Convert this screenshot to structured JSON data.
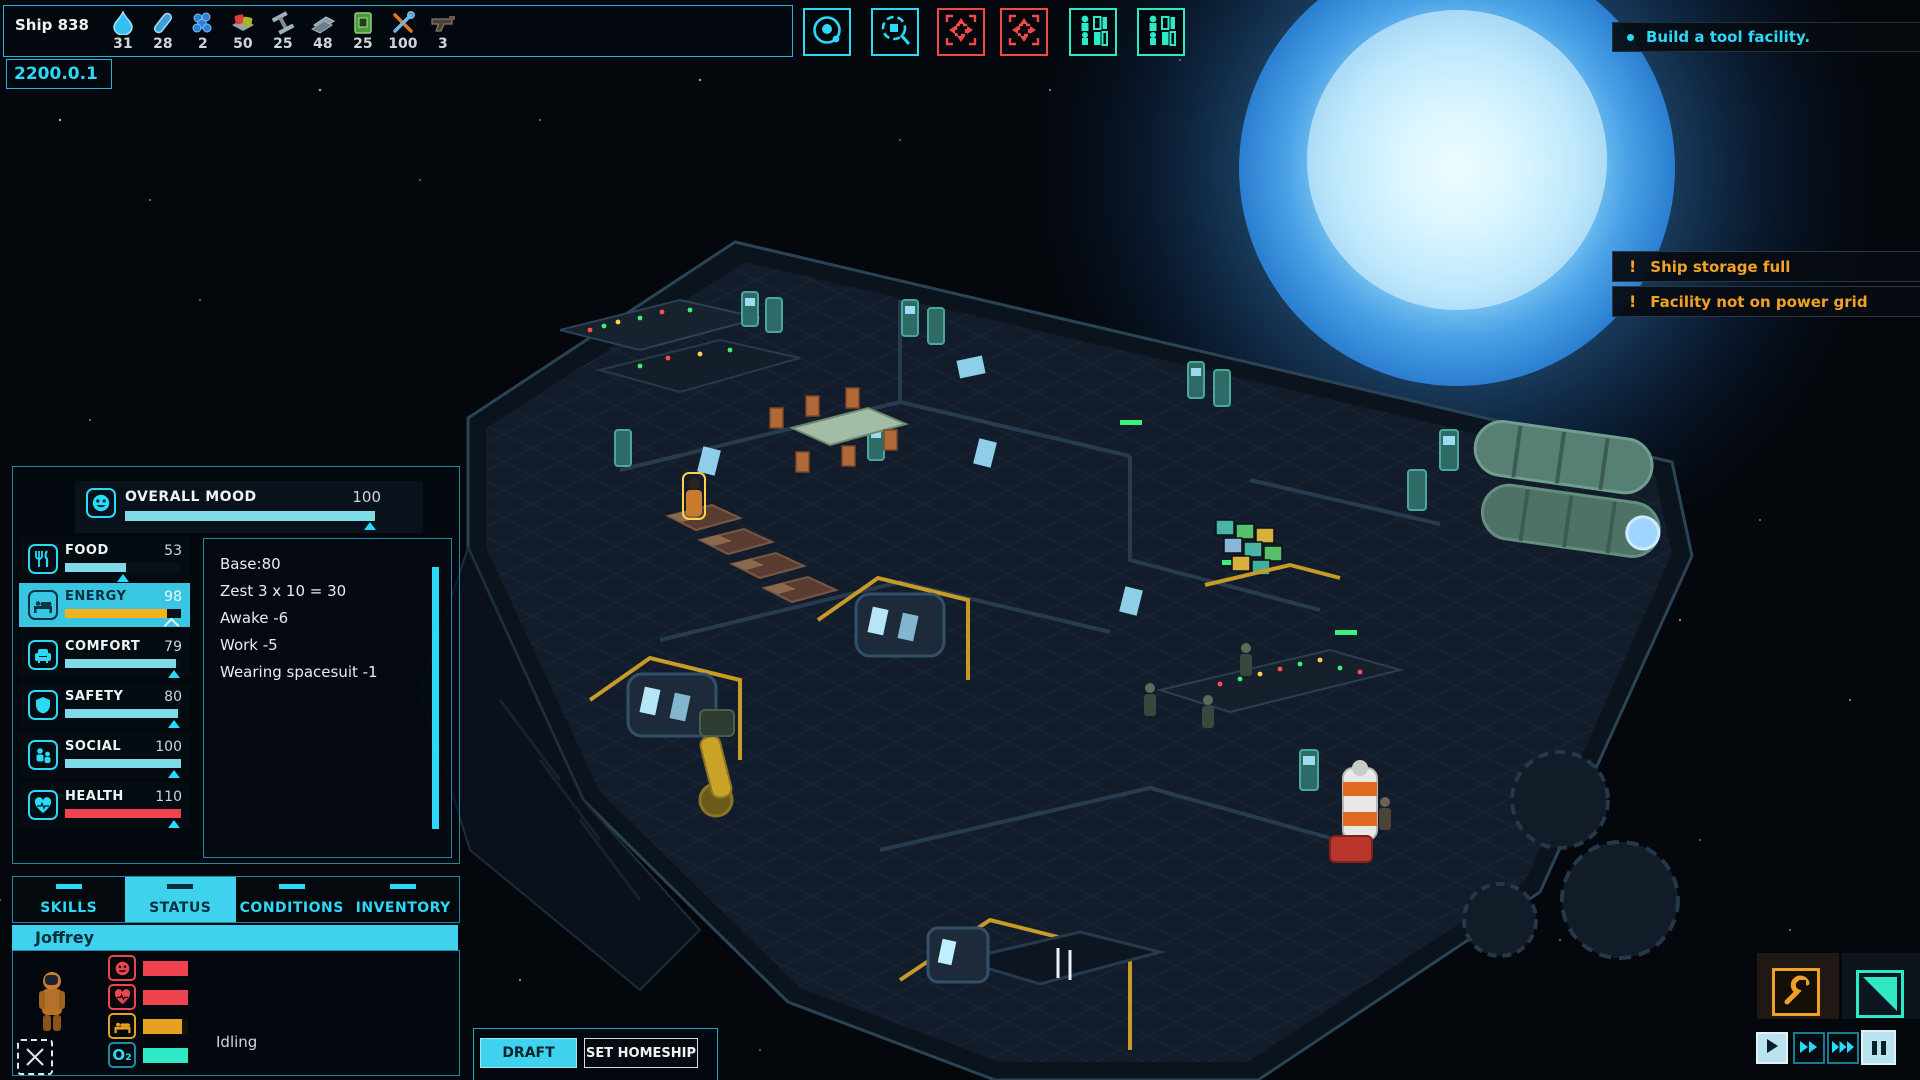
{
  "colors": {
    "accent": "#2bd9f8",
    "warning": "#f0a225",
    "danger": "#ef4450",
    "mint": "#2ee8c6",
    "bar_cyan": "#7fdbe8",
    "bar_orange": "#f2b31d"
  },
  "top_bar": {
    "ship_label": "Ship 838",
    "date": "2200.0.1",
    "resources": [
      {
        "icon": "water-icon",
        "value": "31"
      },
      {
        "icon": "energy-rod-icon",
        "value": "28"
      },
      {
        "icon": "energium-icon",
        "value": "2"
      },
      {
        "icon": "food-icon",
        "value": "50"
      },
      {
        "icon": "infra-block-icon",
        "value": "25"
      },
      {
        "icon": "hull-block-icon",
        "value": "48"
      },
      {
        "icon": "tech-block-icon",
        "value": "25"
      },
      {
        "icon": "tools-icon",
        "value": "100"
      },
      {
        "icon": "weapon-icon",
        "value": "3"
      }
    ]
  },
  "view_toggles": [
    {
      "icon": "orbit-view-icon",
      "color": "#2bd9f8"
    },
    {
      "icon": "scan-view-icon",
      "color": "#2bd9f8"
    },
    {
      "icon": "move-alert-icon",
      "color": "#f44848"
    },
    {
      "icon": "move-alert-icon",
      "color": "#f44848"
    },
    {
      "icon": "crew-manage-icon",
      "color": "#2ee8c6"
    },
    {
      "icon": "crew-manage-icon",
      "color": "#2ee8c6"
    }
  ],
  "objectives": {
    "items": [
      {
        "text": "Build a tool facility."
      }
    ]
  },
  "alerts": [
    {
      "icon": "exclamation-icon",
      "text": "Ship storage full"
    },
    {
      "icon": "exclamation-icon",
      "text": "Facility not on power grid"
    }
  ],
  "crew_panel": {
    "overall_mood": {
      "label": "OVERALL MOOD",
      "value": "100",
      "fill": 97,
      "marker": 95
    },
    "needs": [
      {
        "label": "FOOD",
        "value": "53",
        "fill": 53,
        "marker": 50,
        "bar_color": "#7fdbe8",
        "selected": false
      },
      {
        "label": "ENERGY",
        "value": "98",
        "fill": 88,
        "marker": 92,
        "bar_color": "#f2b31d",
        "selected": true
      },
      {
        "label": "COMFORT",
        "value": "79",
        "fill": 96,
        "marker": 94,
        "bar_color": "#7fdbe8",
        "selected": false
      },
      {
        "label": "SAFETY",
        "value": "80",
        "fill": 97,
        "marker": 94,
        "bar_color": "#7fdbe8",
        "selected": false
      },
      {
        "label": "SOCIAL",
        "value": "100",
        "fill": 100,
        "marker": 94,
        "bar_color": "#7fdbe8",
        "selected": false
      },
      {
        "label": "HEALTH",
        "value": "110",
        "fill": 100,
        "marker": 94,
        "bar_color": "#ef4450",
        "selected": false
      }
    ],
    "breakdown": {
      "lines": [
        "Base:80",
        "Zest 3 x 10 = 30",
        "Awake -6",
        "Work -5",
        "Wearing spacesuit -1"
      ]
    },
    "tabs": [
      {
        "label": "SKILLS",
        "active": false
      },
      {
        "label": "STATUS",
        "active": true
      },
      {
        "label": "CONDITIONS",
        "active": false
      },
      {
        "label": "INVENTORY",
        "active": false
      }
    ],
    "crew_member": {
      "name": "Joffrey",
      "status": "Idling",
      "oxygen_label": "O₂",
      "vitals": [
        {
          "icon": "mood-icon",
          "fill": 100,
          "bar_color": "#ef4450",
          "frame": "#ef4450"
        },
        {
          "icon": "health-icon",
          "fill": 100,
          "bar_color": "#ef4450",
          "frame": "#ef4450"
        },
        {
          "icon": "energy-bed-icon",
          "fill": 86,
          "bar_color": "#e8a020",
          "frame": "#e8a020"
        },
        {
          "icon": "oxygen-icon",
          "fill": 100,
          "bar_color": "#2ee8c6",
          "frame": "#2ee8c6"
        }
      ]
    }
  },
  "bottom_actions": {
    "draft_label": "DRAFT",
    "set_homeship_label": "SET HOMESHIP"
  },
  "playback": {
    "buttons": [
      {
        "icon": "play-icon",
        "lit": true
      },
      {
        "icon": "fast-forward-icon",
        "lit": false
      },
      {
        "icon": "fastest-forward-icon",
        "lit": false
      },
      {
        "icon": "pause-icon",
        "lit": true
      }
    ]
  }
}
